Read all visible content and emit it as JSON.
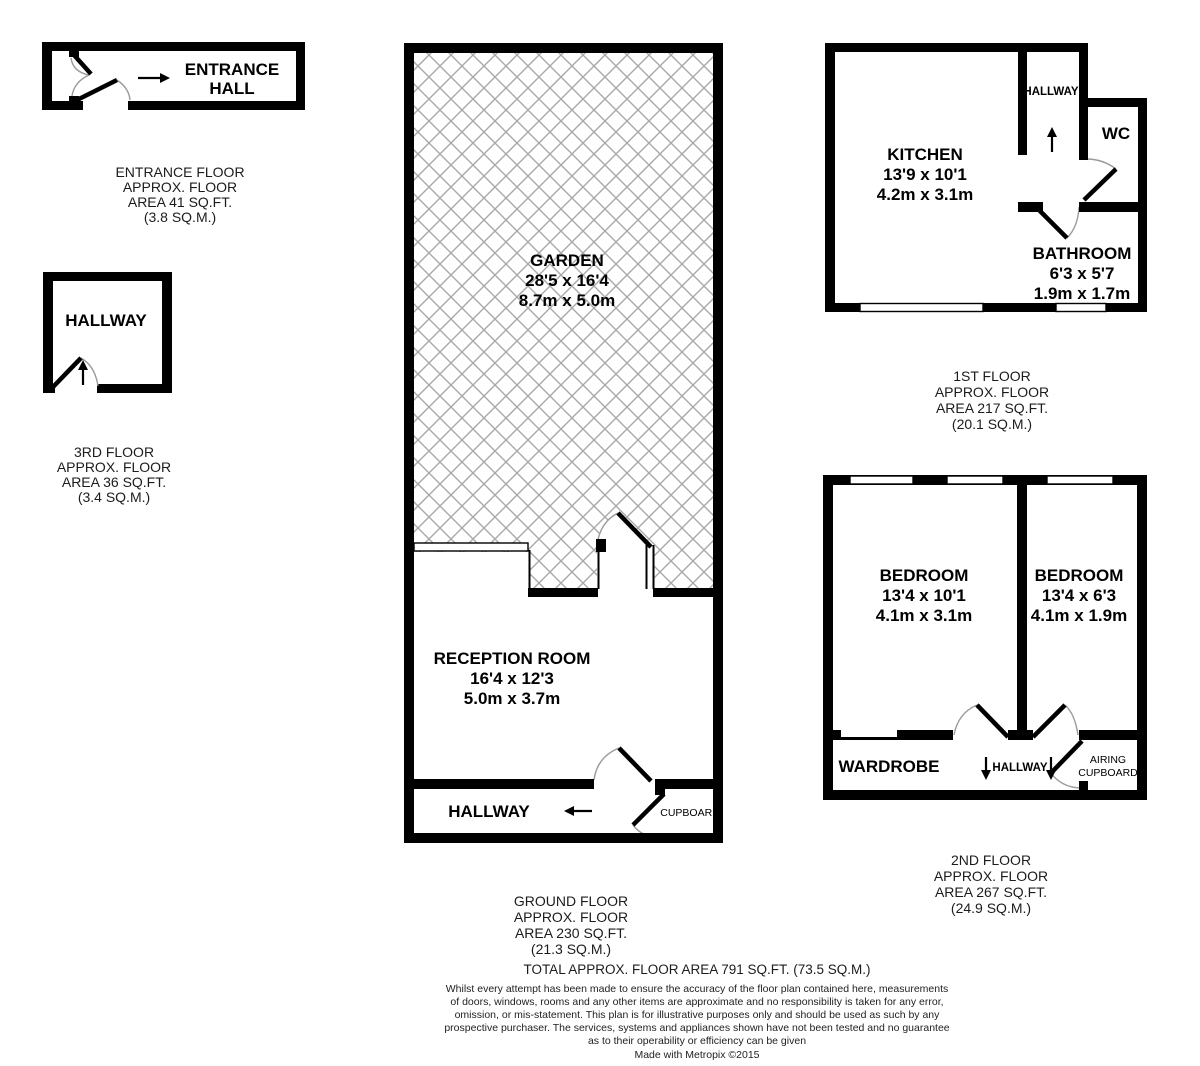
{
  "colors": {
    "wall": "#000000",
    "hatch": "#a8a8a8",
    "swing_arc": "#9a9a9a",
    "text": "#000000",
    "background": "#ffffff"
  },
  "entrance_floor": {
    "room": {
      "line1": "ENTRANCE",
      "line2": "HALL"
    },
    "caption": [
      "ENTRANCE FLOOR",
      "APPROX. FLOOR",
      "AREA 41 SQ.FT.",
      "(3.8 SQ.M.)"
    ]
  },
  "third_floor": {
    "room": "HALLWAY",
    "caption": [
      "3RD FLOOR",
      "APPROX. FLOOR",
      "AREA 36 SQ.FT.",
      "(3.4 SQ.M.)"
    ]
  },
  "ground_floor": {
    "garden": {
      "name": "GARDEN",
      "dims_imperial": "28'5 x 16'4",
      "dims_metric": "8.7m x 5.0m"
    },
    "reception": {
      "name": "RECEPTION ROOM",
      "dims_imperial": "16'4 x 12'3",
      "dims_metric": "5.0m x 3.7m"
    },
    "hallway": "HALLWAY",
    "cupboard": "CUPBOARD",
    "caption": [
      "GROUND FLOOR",
      "APPROX. FLOOR",
      "AREA 230 SQ.FT.",
      "(21.3 SQ.M.)"
    ]
  },
  "first_floor": {
    "kitchen": {
      "name": "KITCHEN",
      "dims_imperial": "13'9 x 10'1",
      "dims_metric": "4.2m x 3.1m"
    },
    "hallway": "HALLWAY",
    "wc": "WC",
    "bathroom": {
      "name": "BATHROOM",
      "dims_imperial": "6'3 x 5'7",
      "dims_metric": "1.9m x 1.7m"
    },
    "caption": [
      "1ST FLOOR",
      "APPROX. FLOOR",
      "AREA 217 SQ.FT.",
      "(20.1 SQ.M.)"
    ]
  },
  "second_floor": {
    "bedroom_left": {
      "name": "BEDROOM",
      "dims_imperial": "13'4 x 10'1",
      "dims_metric": "4.1m x 3.1m"
    },
    "bedroom_right": {
      "name": "BEDROOM",
      "dims_imperial": "13'4 x 6'3",
      "dims_metric": "4.1m x 1.9m"
    },
    "wardrobe": "WARDROBE",
    "hallway": "HALLWAY",
    "airing_cupboard": {
      "line1": "AIRING",
      "line2": "CUPBOARD"
    },
    "caption": [
      "2ND FLOOR",
      "APPROX. FLOOR",
      "AREA 267 SQ.FT.",
      "(24.9 SQ.M.)"
    ]
  },
  "footer": {
    "total": "TOTAL APPROX. FLOOR AREA 791 SQ.FT. (73.5 SQ.M.)",
    "disclaimer": [
      "Whilst every attempt has been made to ensure the accuracy of the floor plan contained here, measurements",
      "of doors, windows, rooms and any other items are approximate and no responsibility is taken for any error,",
      "omission, or mis-statement. This plan is for illustrative purposes only and should be used as such by any",
      "prospective purchaser. The services, systems and appliances shown have not been tested and no guarantee",
      "as to their operability or efficiency can be given"
    ],
    "credit": "Made with Metropix ©2015"
  }
}
